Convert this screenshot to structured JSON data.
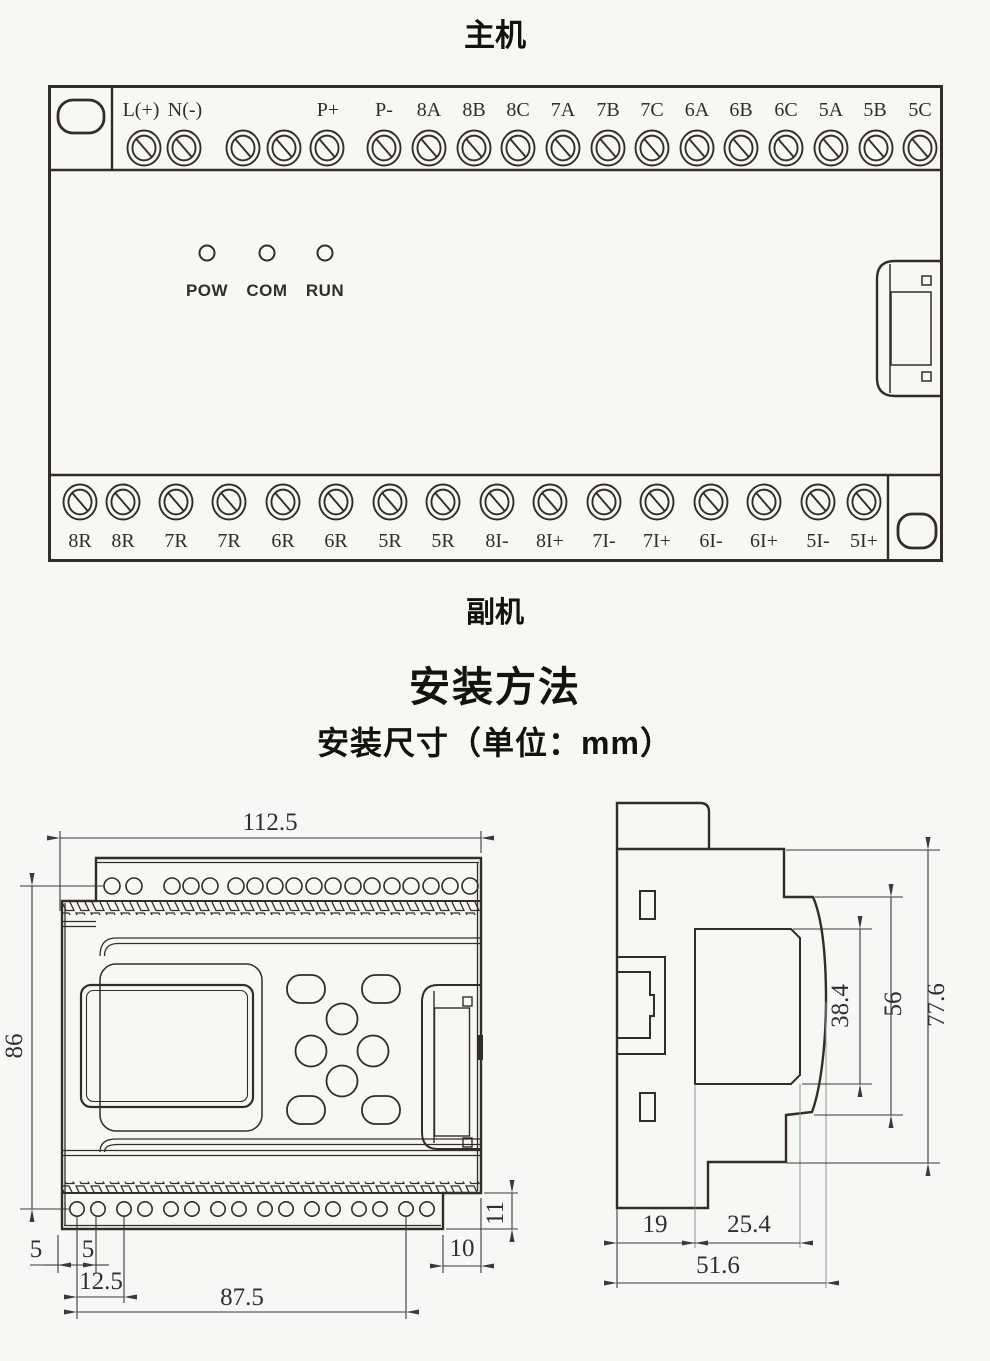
{
  "titles": {
    "main_unit": "主机",
    "sub_unit": "副机",
    "section_heading": "安装方法",
    "sub_heading": "安装尺寸（单位：mm）"
  },
  "colors": {
    "line": "#332d28",
    "dim": "#3a3a3a",
    "ext": "#7e9898",
    "bg": "#f7f7f5"
  },
  "device": {
    "leds": [
      {
        "t": "POW",
        "x": 159
      },
      {
        "t": "COM",
        "x": 219
      },
      {
        "t": "RUN",
        "x": 277
      }
    ],
    "top_screw_xs": [
      96,
      136,
      195,
      236,
      279,
      336,
      381,
      426,
      470,
      515,
      560,
      604,
      649,
      693,
      738,
      783,
      828,
      872
    ],
    "top_terminals": [
      {
        "t": "L(+)",
        "x": 93
      },
      {
        "t": "N(-)",
        "x": 137
      },
      {
        "t": "P+",
        "x": 280
      },
      {
        "t": "P-",
        "x": 336
      },
      {
        "t": "8A",
        "x": 381
      },
      {
        "t": "8B",
        "x": 426
      },
      {
        "t": "8C",
        "x": 470
      },
      {
        "t": "7A",
        "x": 515
      },
      {
        "t": "7B",
        "x": 560
      },
      {
        "t": "7C",
        "x": 604
      },
      {
        "t": "6A",
        "x": 649
      },
      {
        "t": "6B",
        "x": 693
      },
      {
        "t": "6C",
        "x": 738
      },
      {
        "t": "5A",
        "x": 783
      },
      {
        "t": "5B",
        "x": 827
      },
      {
        "t": "5C",
        "x": 872
      }
    ],
    "bottom_terminals": [
      {
        "t": "8R",
        "x": 32
      },
      {
        "t": "8R",
        "x": 75
      },
      {
        "t": "7R",
        "x": 128
      },
      {
        "t": "7R",
        "x": 181
      },
      {
        "t": "6R",
        "x": 235
      },
      {
        "t": "6R",
        "x": 288
      },
      {
        "t": "5R",
        "x": 342
      },
      {
        "t": "5R",
        "x": 395
      },
      {
        "t": "8I-",
        "x": 449
      },
      {
        "t": "8I+",
        "x": 502
      },
      {
        "t": "7I-",
        "x": 556
      },
      {
        "t": "7I+",
        "x": 609
      },
      {
        "t": "6I-",
        "x": 663
      },
      {
        "t": "6I+",
        "x": 716
      },
      {
        "t": "5I-",
        "x": 770
      },
      {
        "t": "5I+",
        "x": 816
      }
    ]
  },
  "front_view": {
    "top_hole_xs": [
      112,
      134,
      172,
      191,
      210,
      236,
      255,
      275,
      294,
      314,
      333,
      353,
      372,
      392,
      411,
      431,
      450,
      470
    ],
    "bottom_hole_xs": [
      77,
      98,
      124,
      145,
      171,
      192,
      218,
      239,
      265,
      286,
      312,
      333,
      359,
      380,
      406,
      427
    ],
    "dims": {
      "width": "112.5",
      "height": "86",
      "edge_offset": "5",
      "hole_gap": "5",
      "pair_pitch": "12.5",
      "mount_span": "87.5",
      "notch_width": "10",
      "notch_height": "11"
    }
  },
  "side_view": {
    "dims": {
      "clip_depth": "19",
      "face_depth": "25.4",
      "total_depth": "51.6",
      "panel_height": "38.4",
      "body_height": "56",
      "total_height": "77.6"
    }
  }
}
